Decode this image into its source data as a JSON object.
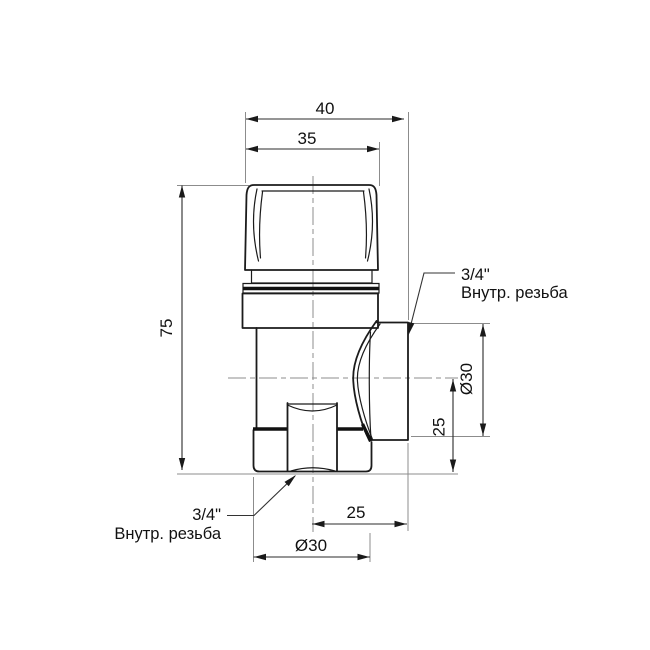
{
  "drawing": {
    "dims": {
      "overall_depth": "40",
      "cap_width": "35",
      "body_height": "75",
      "outlet_diameter": "Ø30",
      "outlet_axis_to_bottom": "25",
      "inlet_center_to_face": "25",
      "inlet_nut_diameter": "Ø30"
    },
    "outlet_label": {
      "size": "3/4\"",
      "type": "Внутр. резьба"
    },
    "inlet_label": {
      "size": "3/4\"",
      "type": "Внутр. резьба"
    },
    "colors": {
      "outline": "#1b1b1b",
      "dimension": "#2b2b2b",
      "auxiliary": "#8c8c8c",
      "background": "#ffffff"
    }
  }
}
